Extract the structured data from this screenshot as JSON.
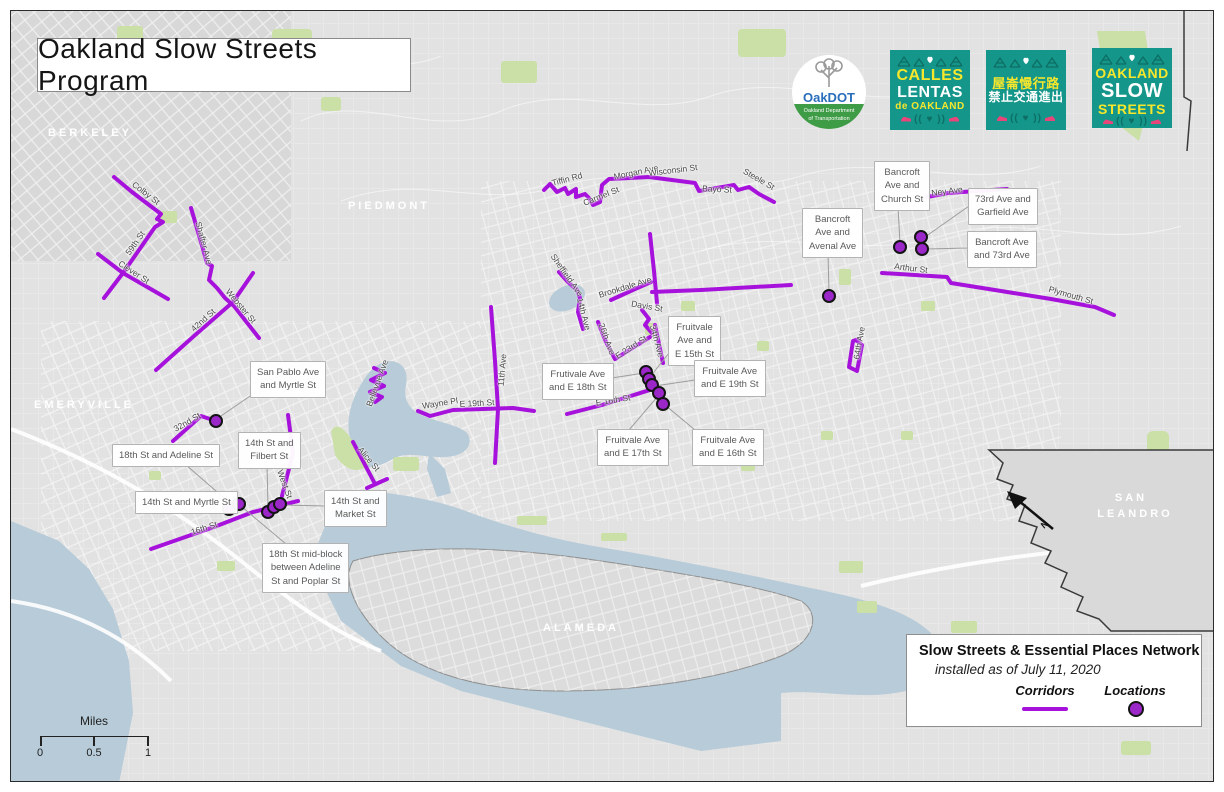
{
  "title": {
    "text": "Oakland Slow Streets Program"
  },
  "colors": {
    "corridor": "#a612dc",
    "location": "#9b27c9",
    "water": "#b7cbd8",
    "green": "#cbe0a6",
    "land": "#e2e2e2",
    "teal": "#14968a",
    "yellow": "#f6e72c",
    "pink": "#e8457a",
    "oakdot_blue": "#2a6ebb"
  },
  "logos": {
    "oakdot": {
      "name": "OakDOT",
      "sub1": "Oakland Department",
      "sub2": "of Transportation"
    },
    "badges": [
      {
        "id": "calles-lentas",
        "x": 890,
        "y": 50,
        "lines": [
          {
            "text": "CALLES",
            "color": "yellow",
            "size": 16
          },
          {
            "text": "LENTAS",
            "color": "white",
            "size": 16
          },
          {
            "text": "de OAKLAND",
            "color": "yellow",
            "size": 10
          }
        ]
      },
      {
        "id": "chinese",
        "x": 986,
        "y": 50,
        "lines": [
          {
            "text": "屋崙慢行路",
            "color": "yellow",
            "size": 13
          },
          {
            "text": "禁止交通進出",
            "color": "white",
            "size": 12
          }
        ]
      },
      {
        "id": "oakland-slow-streets",
        "x": 1092,
        "y": 48,
        "lines": [
          {
            "text": "OAKLAND",
            "color": "yellow",
            "size": 14
          },
          {
            "text": "SLOW",
            "color": "white",
            "size": 20
          },
          {
            "text": "STREETS",
            "color": "yellow",
            "size": 14
          }
        ]
      }
    ]
  },
  "legend": {
    "title": "Slow Streets & Essential Places Network",
    "subtitle": "installed as of July 11, 2020",
    "corridors_label": "Corridors",
    "locations_label": "Locations"
  },
  "scalebar": {
    "unit": "Miles",
    "t0": "0",
    "t1": "0.5",
    "t2": "1"
  },
  "north": {
    "label": "N"
  },
  "map": {
    "city_labels": [
      {
        "text": "BERKELEY",
        "x": 90,
        "y": 133
      },
      {
        "text": "PIEDMONT",
        "x": 389,
        "y": 206
      },
      {
        "text": "EMERYVILLE",
        "x": 84,
        "y": 405
      },
      {
        "text": "ALAMEDA",
        "x": 581,
        "y": 628
      },
      {
        "text": "SAN",
        "x": 1131,
        "y": 498
      },
      {
        "text": "LEANDRO",
        "x": 1135,
        "y": 514
      }
    ],
    "street_labels": [
      {
        "text": "Colby St",
        "x": 146,
        "y": 193,
        "rot": 37
      },
      {
        "text": "59th St",
        "x": 135,
        "y": 243,
        "rot": -55
      },
      {
        "text": "Clever St",
        "x": 134,
        "y": 272,
        "rot": 33
      },
      {
        "text": "Shafter Ave",
        "x": 204,
        "y": 243,
        "rot": 75
      },
      {
        "text": "Webster St",
        "x": 241,
        "y": 306,
        "rot": 50
      },
      {
        "text": "42nd St",
        "x": 203,
        "y": 320,
        "rot": -42
      },
      {
        "text": "Tiffin Rd",
        "x": 567,
        "y": 179,
        "rot": -15
      },
      {
        "text": "Carmel St",
        "x": 601,
        "y": 196,
        "rot": -22
      },
      {
        "text": "Morgan Ave",
        "x": 636,
        "y": 172,
        "rot": -12
      },
      {
        "text": "Wisconsin St",
        "x": 673,
        "y": 170,
        "rot": -7
      },
      {
        "text": "Bayo St",
        "x": 717,
        "y": 189,
        "rot": 3
      },
      {
        "text": "Steele St",
        "x": 759,
        "y": 179,
        "rot": 30
      },
      {
        "text": "Ney Ave",
        "x": 947,
        "y": 191,
        "rot": -7
      },
      {
        "text": "Arthur St",
        "x": 911,
        "y": 268,
        "rot": 7
      },
      {
        "text": "Plymouth St",
        "x": 1071,
        "y": 295,
        "rot": 16
      },
      {
        "text": "64th Ave",
        "x": 859,
        "y": 343,
        "rot": -80
      },
      {
        "text": "Sheffield Ave",
        "x": 567,
        "y": 275,
        "rot": 55
      },
      {
        "text": "14th Ave",
        "x": 584,
        "y": 314,
        "rot": 75
      },
      {
        "text": "Brookdale Ave",
        "x": 625,
        "y": 287,
        "rot": -17
      },
      {
        "text": "Davis St",
        "x": 647,
        "y": 306,
        "rot": 10
      },
      {
        "text": "26th Ave",
        "x": 607,
        "y": 339,
        "rot": 70
      },
      {
        "text": "E 23rd St",
        "x": 631,
        "y": 347,
        "rot": -33
      },
      {
        "text": "34th Ave",
        "x": 657,
        "y": 341,
        "rot": 75
      },
      {
        "text": "E 16th St",
        "x": 613,
        "y": 400,
        "rot": -9
      },
      {
        "text": "Bellevue Ave",
        "x": 377,
        "y": 383,
        "rot": -70
      },
      {
        "text": "Wayne Pl",
        "x": 440,
        "y": 403,
        "rot": -9
      },
      {
        "text": "E 19th St",
        "x": 477,
        "y": 403,
        "rot": -3
      },
      {
        "text": "11th Ave",
        "x": 502,
        "y": 370,
        "rot": -85
      },
      {
        "text": "32nd St",
        "x": 187,
        "y": 422,
        "rot": -30
      },
      {
        "text": "West St",
        "x": 285,
        "y": 484,
        "rot": 70
      },
      {
        "text": "16th St",
        "x": 204,
        "y": 528,
        "rot": -18
      },
      {
        "text": "Alice St",
        "x": 369,
        "y": 459,
        "rot": 50
      }
    ],
    "corridors": [
      {
        "id": "colby-59th",
        "pts": [
          [
            113,
            176
          ],
          [
            131,
            191
          ],
          [
            160,
            213
          ],
          [
            156,
            218
          ],
          [
            162,
            221
          ],
          [
            154,
            226
          ],
          [
            122,
            272
          ],
          [
            103,
            297
          ]
        ]
      },
      {
        "id": "clever",
        "pts": [
          [
            97,
            253
          ],
          [
            122,
            272
          ],
          [
            167,
            298
          ]
        ]
      },
      {
        "id": "shafter-webster",
        "pts": [
          [
            190,
            207
          ],
          [
            200,
            241
          ],
          [
            206,
            262
          ],
          [
            211,
            265
          ],
          [
            208,
            279
          ],
          [
            216,
            287
          ],
          [
            224,
            297
          ],
          [
            233,
            305
          ],
          [
            258,
            337
          ]
        ]
      },
      {
        "id": "42nd",
        "pts": [
          [
            252,
            272
          ],
          [
            232,
            301
          ],
          [
            193,
            335
          ],
          [
            155,
            369
          ]
        ]
      },
      {
        "id": "laurel-loop",
        "pts": [
          [
            543,
            189
          ],
          [
            549,
            183
          ],
          [
            556,
            191
          ],
          [
            564,
            187
          ],
          [
            567,
            193
          ],
          [
            575,
            188
          ],
          [
            575,
            196
          ],
          [
            584,
            193
          ],
          [
            588,
            197
          ],
          [
            592,
            204
          ],
          [
            599,
            201
          ],
          [
            601,
            184
          ],
          [
            608,
            178
          ],
          [
            629,
            177
          ],
          [
            648,
            176
          ],
          [
            694,
            182
          ],
          [
            698,
            190
          ],
          [
            733,
            184
          ],
          [
            737,
            189
          ],
          [
            748,
            186
          ],
          [
            758,
            193
          ],
          [
            773,
            201
          ]
        ]
      },
      {
        "id": "sheffield-14th",
        "pts": [
          [
            558,
            271
          ],
          [
            567,
            281
          ],
          [
            576,
            289
          ],
          [
            579,
            297
          ],
          [
            577,
            311
          ],
          [
            582,
            328
          ]
        ]
      },
      {
        "id": "brookdale-diag",
        "pts": [
          [
            610,
            299
          ],
          [
            634,
            288
          ],
          [
            650,
            281
          ]
        ]
      },
      {
        "id": "brookdale-east",
        "pts": [
          [
            651,
            291
          ],
          [
            700,
            289
          ],
          [
            790,
            284
          ]
        ]
      },
      {
        "id": "34th-upper",
        "pts": [
          [
            649,
            233
          ],
          [
            653,
            270
          ],
          [
            656,
            302
          ]
        ]
      },
      {
        "id": "davis",
        "pts": [
          [
            641,
            309
          ],
          [
            648,
            318
          ],
          [
            644,
            324
          ],
          [
            651,
            332
          ]
        ]
      },
      {
        "id": "34th-lower",
        "pts": [
          [
            654,
            324
          ],
          [
            658,
            343
          ],
          [
            662,
            362
          ]
        ]
      },
      {
        "id": "26th",
        "pts": [
          [
            597,
            321
          ],
          [
            605,
            341
          ],
          [
            614,
            358
          ]
        ]
      },
      {
        "id": "e23rd",
        "pts": [
          [
            614,
            358
          ],
          [
            649,
            336
          ]
        ]
      },
      {
        "id": "e16th",
        "pts": [
          [
            566,
            413
          ],
          [
            601,
            404
          ],
          [
            652,
            388
          ]
        ]
      },
      {
        "id": "ney",
        "pts": [
          [
            926,
            196
          ],
          [
            947,
            192
          ],
          [
            1006,
            188
          ]
        ]
      },
      {
        "id": "arthur-plymouth",
        "pts": [
          [
            881,
            272
          ],
          [
            946,
            276
          ],
          [
            950,
            282
          ],
          [
            1000,
            290
          ],
          [
            1050,
            298
          ],
          [
            1094,
            306
          ],
          [
            1113,
            314
          ]
        ]
      },
      {
        "id": "64th-loop",
        "pts": [
          [
            858,
            338
          ],
          [
            852,
            340
          ],
          [
            848,
            366
          ],
          [
            856,
            370
          ],
          [
            861,
            344
          ],
          [
            856,
            340
          ]
        ]
      },
      {
        "id": "11th",
        "pts": [
          [
            490,
            306
          ],
          [
            494,
            360
          ],
          [
            497,
            408
          ],
          [
            494,
            462
          ]
        ]
      },
      {
        "id": "e19th-wayne",
        "pts": [
          [
            417,
            410
          ],
          [
            429,
            415
          ],
          [
            452,
            409
          ],
          [
            512,
            407
          ],
          [
            533,
            410
          ]
        ]
      },
      {
        "id": "bellevue",
        "pts": [
          [
            373,
            367
          ],
          [
            384,
            372
          ],
          [
            370,
            379
          ],
          [
            383,
            385
          ],
          [
            369,
            391
          ],
          [
            381,
            396
          ],
          [
            374,
            401
          ]
        ]
      },
      {
        "id": "west",
        "pts": [
          [
            287,
            414
          ],
          [
            292,
            452
          ],
          [
            281,
            495
          ]
        ]
      },
      {
        "id": "16th",
        "pts": [
          [
            150,
            548
          ],
          [
            213,
            526
          ],
          [
            252,
            511
          ],
          [
            297,
            500
          ]
        ]
      },
      {
        "id": "32nd",
        "pts": [
          [
            172,
            440
          ],
          [
            200,
            415
          ],
          [
            212,
            419
          ]
        ]
      },
      {
        "id": "alice",
        "pts": [
          [
            352,
            441
          ],
          [
            373,
            481
          ]
        ]
      },
      {
        "id": "alice-tick",
        "pts": [
          [
            366,
            487
          ],
          [
            386,
            478
          ]
        ]
      }
    ],
    "locations": [
      [
        215,
        420
      ],
      [
        228,
        508
      ],
      [
        238,
        503
      ],
      [
        267,
        511
      ],
      [
        273,
        506
      ],
      [
        279,
        503
      ],
      [
        645,
        371
      ],
      [
        648,
        378
      ],
      [
        651,
        384
      ],
      [
        658,
        392
      ],
      [
        662,
        403
      ],
      [
        828,
        295
      ],
      [
        899,
        246
      ],
      [
        920,
        236
      ],
      [
        921,
        248
      ]
    ],
    "callouts": [
      {
        "x": 250,
        "y": 361,
        "lines": [
          "San Pablo Ave",
          "and Myrtle St"
        ],
        "leader": [
          255,
          391,
          217,
          417
        ]
      },
      {
        "x": 112,
        "y": 444,
        "lines": [
          "18th St and Adeline St"
        ],
        "leader": [
          185,
          464,
          230,
          503
        ]
      },
      {
        "x": 238,
        "y": 432,
        "lines": [
          "14th St and",
          "Filbert St"
        ],
        "leader": [
          266,
          464,
          267,
          505
        ]
      },
      {
        "x": 135,
        "y": 491,
        "lines": [
          "14th St and Myrtle St"
        ],
        "leader": [
          224,
          502,
          229,
          506
        ]
      },
      {
        "x": 324,
        "y": 490,
        "lines": [
          "14th St and",
          "Market St"
        ],
        "leader": [
          324,
          505,
          282,
          504
        ]
      },
      {
        "x": 262,
        "y": 543,
        "lines": [
          "18th St mid-block",
          "between Adeline",
          "St and Poplar St"
        ],
        "leader": [
          285,
          543,
          241,
          506
        ]
      },
      {
        "x": 542,
        "y": 363,
        "lines": [
          "Frutivale Ave",
          "and E 18th St"
        ],
        "leader": [
          604,
          378,
          643,
          372
        ]
      },
      {
        "x": 668,
        "y": 316,
        "lines": [
          "Fruitvale",
          "Ave and",
          "E 15th St"
        ],
        "leader": [
          668,
          352,
          649,
          376
        ]
      },
      {
        "x": 694,
        "y": 360,
        "lines": [
          "Fruitvale Ave",
          "and E 19th St"
        ],
        "leader": [
          694,
          379,
          654,
          385
        ]
      },
      {
        "x": 597,
        "y": 429,
        "lines": [
          "Fruitvale Ave",
          "and E 17th St"
        ],
        "leader": [
          628,
          429,
          657,
          395
        ]
      },
      {
        "x": 692,
        "y": 429,
        "lines": [
          "Fruitvale Ave",
          "and E 16th St"
        ],
        "leader": [
          694,
          429,
          664,
          404
        ]
      },
      {
        "x": 802,
        "y": 208,
        "lines": [
          "Bancroft",
          "Ave and",
          "Avenal Ave"
        ],
        "leader": [
          827,
          252,
          828,
          292
        ]
      },
      {
        "x": 874,
        "y": 161,
        "lines": [
          "Bancroft",
          "Ave and",
          "Church St"
        ],
        "leader": [
          897,
          205,
          899,
          243
        ]
      },
      {
        "x": 968,
        "y": 188,
        "lines": [
          "73rd Ave and",
          "Garfield Ave"
        ],
        "leader": [
          968,
          205,
          924,
          236
        ]
      },
      {
        "x": 967,
        "y": 231,
        "lines": [
          "Bancroft Ave",
          "and 73rd Ave"
        ],
        "leader": [
          967,
          247,
          925,
          248
        ]
      }
    ]
  }
}
